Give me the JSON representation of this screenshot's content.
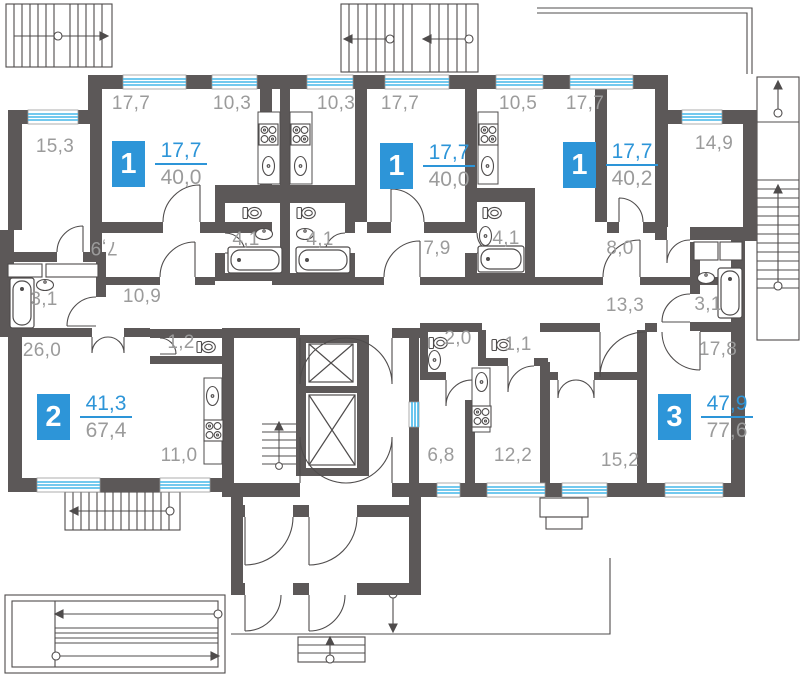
{
  "title": "apartment-floor-plan",
  "colors": {
    "wall": "#5c5858",
    "line": "#4f4c4c",
    "window_blue": "#45b7e9",
    "accent_blue": "#2d95d8",
    "label_gray": "#9b9b9b"
  },
  "apartments": [
    {
      "number": "1",
      "living_area": "17,7",
      "total_area": "40,0"
    },
    {
      "number": "1",
      "living_area": "17,7",
      "total_area": "40,0"
    },
    {
      "number": "1",
      "living_area": "17,7",
      "total_area": "40,2"
    },
    {
      "number": "2",
      "living_area": "41,3",
      "total_area": "67,4"
    },
    {
      "number": "3",
      "living_area": "47,9",
      "total_area": "77,6"
    }
  ],
  "rooms": [
    {
      "label": "15,3"
    },
    {
      "label": "17,7"
    },
    {
      "label": "10,3"
    },
    {
      "label": "10,3"
    },
    {
      "label": "17,7"
    },
    {
      "label": "10,5"
    },
    {
      "label": "17,7"
    },
    {
      "label": "14,9"
    },
    {
      "label": "7,9"
    },
    {
      "label": "4,1"
    },
    {
      "label": "4,1"
    },
    {
      "label": "7,9"
    },
    {
      "label": "4,1"
    },
    {
      "label": "8,0"
    },
    {
      "label": "3,1"
    },
    {
      "label": "10,9"
    },
    {
      "label": "13,3"
    },
    {
      "label": "3,1"
    },
    {
      "label": "26,0"
    },
    {
      "label": "1,2"
    },
    {
      "label": "2,0"
    },
    {
      "label": "1,1"
    },
    {
      "label": "17,8"
    },
    {
      "label": "11,0"
    },
    {
      "label": "6,8"
    },
    {
      "label": "12,2"
    },
    {
      "label": "15,2"
    }
  ],
  "icons": [
    "window",
    "door-arc",
    "bathtub-icon",
    "toilet-icon",
    "sink-icon",
    "stove-icon",
    "elevator-icon",
    "staircase-icon",
    "ramp-icon",
    "entrance-steps-icon",
    "balcony-outline"
  ]
}
